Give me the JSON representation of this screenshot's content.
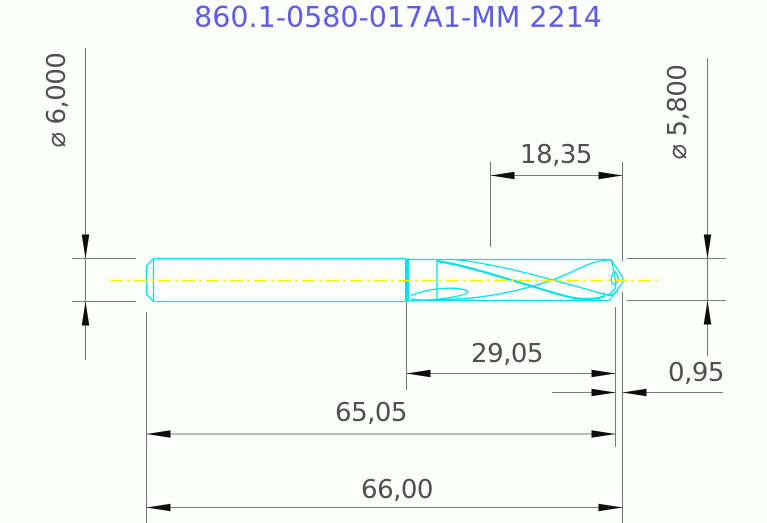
{
  "title": "860.1-0580-017A1-MM 2214",
  "colors": {
    "drill": "#00e4f0",
    "centerline": "#ffef00",
    "title": "#5c5ce6",
    "lines": "#7a7a7a",
    "arrows": "#0d0d0d",
    "dim_text": "#4f4f4f"
  },
  "dimensions": {
    "shank_diameter": {
      "label": "⌀ 6,000",
      "value": "6.000",
      "unit": "mm"
    },
    "point_diameter": {
      "label": "⌀ 5,800",
      "value": "5.800",
      "unit": "mm"
    },
    "flute_length": {
      "label": "18,35",
      "value": "18.35",
      "unit": "mm"
    },
    "body_length": {
      "label": "29,05",
      "value": "29.05",
      "unit": "mm"
    },
    "point_length": {
      "label": "0,95",
      "value": "0.95",
      "unit": "mm"
    },
    "length_to_point": {
      "label": "65,05",
      "value": "65.05",
      "unit": "mm"
    },
    "overall_length": {
      "label": "66,00",
      "value": "66.00",
      "unit": "mm"
    }
  }
}
